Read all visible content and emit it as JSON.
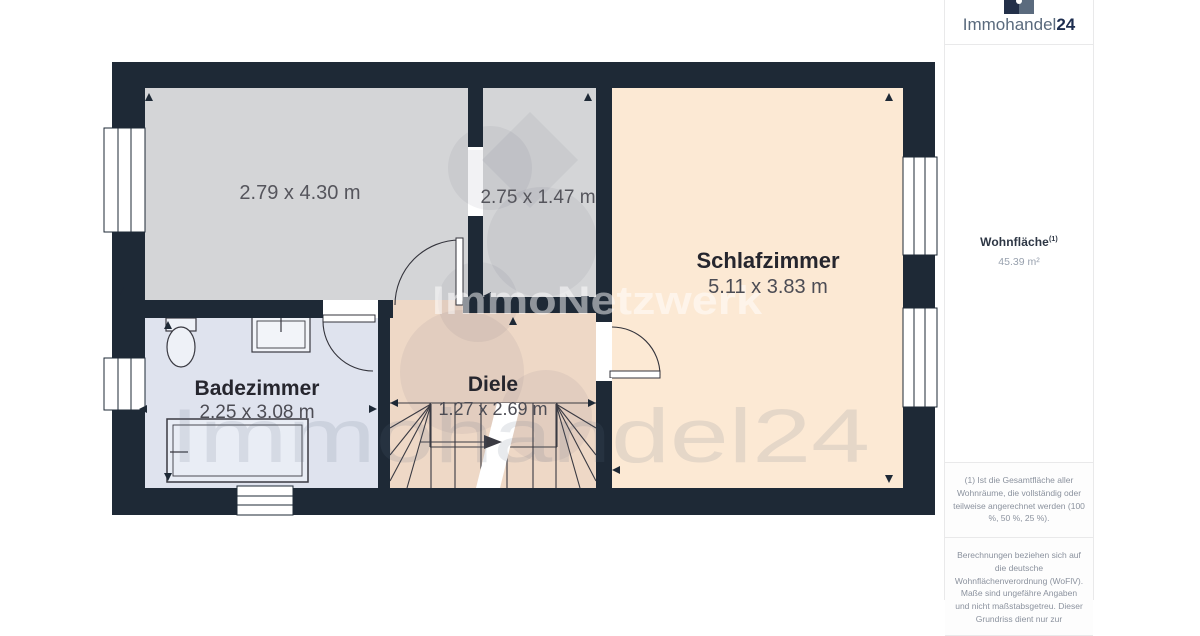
{
  "brand": {
    "logo_text_main": "Immohandel",
    "logo_text_suffix": "24"
  },
  "sidebar": {
    "area_label": "Wohnfläche",
    "area_label_sup": "(1)",
    "area_value": "45.39 m²",
    "footnote_1": "(1) Ist die Gesamtfläche aller Wohnräume, die vollständig oder teilweise angerechnet werden (100 %, 50 %, 25 %).",
    "footnote_2": "Berechnungen beziehen sich auf die deutsche Wohnflächenverordnung (WoFlV). Maße sind ungefähre Angaben und nicht maßstabsgetreu. Dieser Grundriss dient nur zur"
  },
  "floorplan": {
    "rooms": [
      {
        "id": "room-top-left",
        "name": "",
        "dimensions": "2.79 x 4.30 m"
      },
      {
        "id": "room-top-middle",
        "name": "",
        "dimensions": "2.75 x 1.47 m"
      },
      {
        "id": "schlafzimmer",
        "name": "Schlafzimmer",
        "dimensions": "5.11 x 3.83 m"
      },
      {
        "id": "badezimmer",
        "name": "Badezimmer",
        "dimensions": "2.25 x 3.08 m"
      },
      {
        "id": "diele",
        "name": "Diele",
        "dimensions": "1.27 x 2.69 m"
      }
    ],
    "watermark_center": "ImmoNetzwerk",
    "watermark_large": "Immohandel24"
  },
  "colors": {
    "wall": "#1e2936",
    "room_gray": "#d4d5d7",
    "room_cream": "#fce9d4",
    "room_tan": "#eed8c6",
    "room_blue": "#dfe3ee",
    "logo_navy": "#1d2d4f",
    "logo_gray": "#5a6a7d"
  }
}
